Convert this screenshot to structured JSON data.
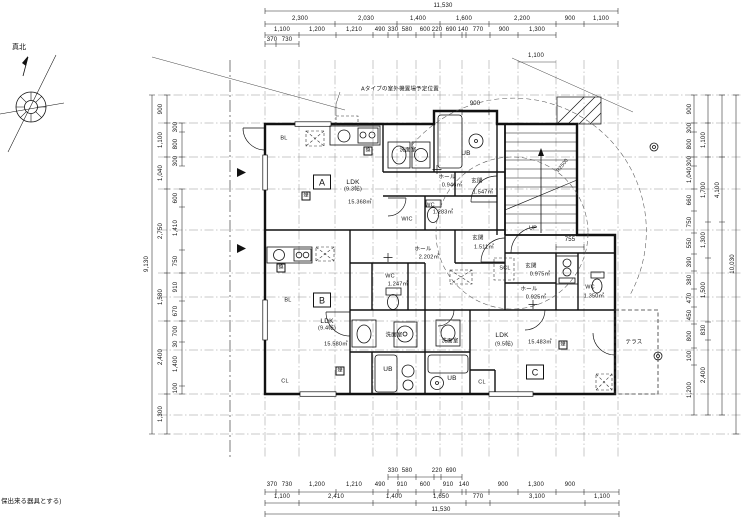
{
  "notes": {
    "north": "真北",
    "outdoor_unit": "Aタイプの室外機置場予定位置",
    "bottom": "保出来る器具とする)"
  },
  "stairs": {
    "up": "UP",
    "radius": "R2500"
  },
  "symbols": {
    "smoke": "煙",
    "vent": "換"
  },
  "dims": {
    "top": {
      "total": "11,530",
      "row2": [
        "2,300",
        "2,030",
        "1,400",
        "1,600",
        "2,200",
        "900",
        "1,100"
      ],
      "row3": [
        "1,100",
        "1,200",
        "1,210",
        "490",
        "330",
        "580",
        "600",
        "220",
        "690",
        "140",
        "770",
        "900",
        "1,300"
      ],
      "row4": [
        "370",
        "730"
      ],
      "diag": "1,100"
    },
    "bottom": {
      "sub": [
        "330",
        "580",
        "220",
        "690"
      ],
      "row2": [
        "370",
        "730",
        "1,200",
        "1,210",
        "490",
        "910",
        "600",
        "910",
        "140",
        "900",
        "1,300",
        "900"
      ],
      "row3": [
        "1,100",
        "2,410",
        "1,400",
        "1,650",
        "770",
        "3,100",
        "1,100"
      ],
      "total": "11,530"
    },
    "left": {
      "total": "9,130",
      "main": [
        "900",
        "1,100",
        "1,040",
        "2,750",
        "1,580",
        "2,400",
        "1,300"
      ],
      "sub": [
        "300",
        "800",
        "300",
        "600",
        "1,410",
        "750",
        "910",
        "670",
        "700",
        "30",
        "1,400",
        "100"
      ]
    },
    "right": {
      "total": "10,030",
      "outer": "4,100",
      "mid": [
        "1,100",
        "1,700",
        "1,300",
        "1,500",
        "830",
        "2,400"
      ],
      "inner": [
        "900",
        "300",
        "800",
        "300",
        "1,040",
        "660",
        "750",
        "550",
        "390",
        "380",
        "470",
        "450",
        "800",
        "100",
        "1,200"
      ]
    },
    "inner": {
      "stair": "900",
      "genkan_c": "755"
    }
  },
  "units": {
    "a": {
      "tag": "A",
      "ldk": "LDK",
      "tatami": "(9.3帖)",
      "area": "15.368㎡",
      "senmen": "洗面室",
      "ub": "UB",
      "bl": "BL",
      "hall": "ホール",
      "hall_area": "0.946㎡",
      "genkan": "玄関",
      "genkan_area": "1.547㎡",
      "wc": "WC",
      "wc_area": "1.283㎡",
      "wic": "WIC"
    },
    "b": {
      "tag": "B",
      "ldk": "LDK",
      "tatami": "(9.4帖)",
      "area": "15.580㎡",
      "genkan": "玄関",
      "genkan_area": "1.511㎡",
      "hall": "ホール",
      "hall_area": "2.202㎡",
      "wc": "WC",
      "wc_area": "1.247㎡",
      "senmen": "洗面室",
      "ub": "UB",
      "bl": "BL",
      "cl": "CL"
    },
    "c": {
      "tag": "C",
      "ldk": "LDK",
      "tatami": "(9.5帖)",
      "area": "15.483㎡",
      "genkan": "玄関",
      "genkan_area": "0.975㎡",
      "hall": "ホール",
      "hall_area": "0.925㎡",
      "wc": "WC",
      "wc_area": "1.350㎡",
      "scl": "SCL",
      "senmen": "洗面室",
      "ub": "UB",
      "cl": "CL",
      "terrace": "テラス"
    }
  }
}
